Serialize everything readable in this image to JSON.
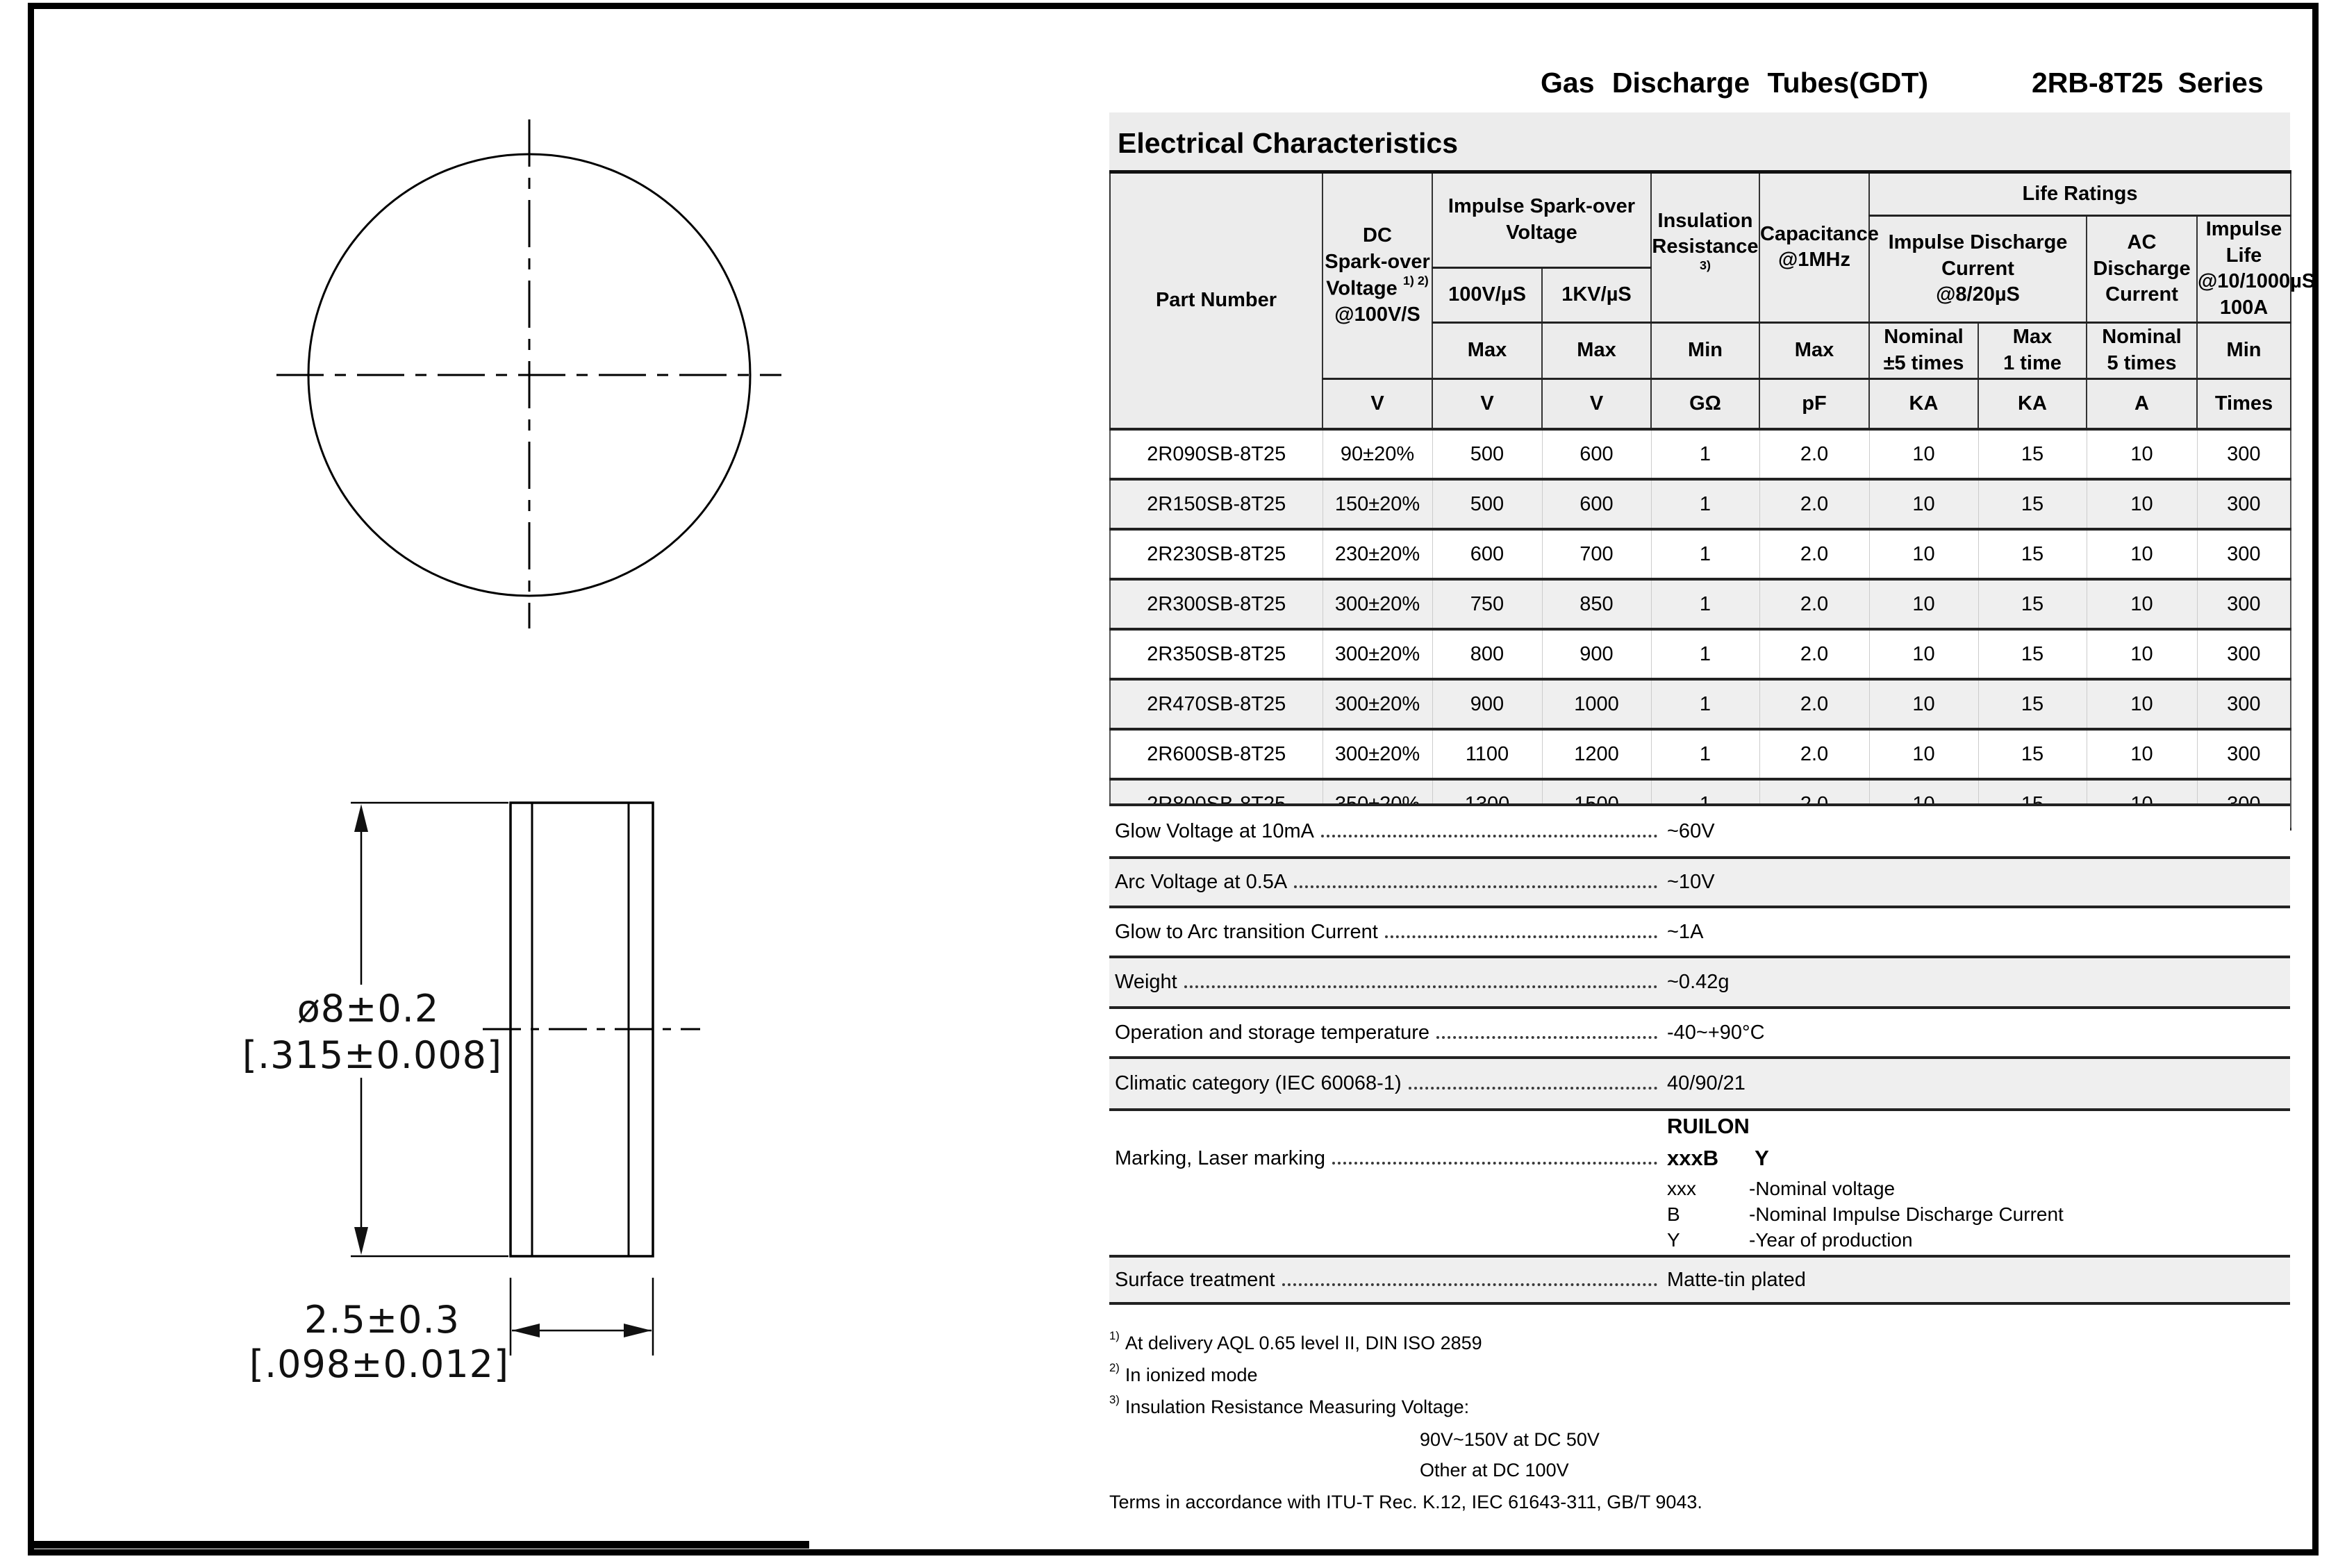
{
  "header": {
    "product": "Gas Discharge Tubes(GDT)",
    "series": "2RB-8T25 Series"
  },
  "section": {
    "title": "Electrical Characteristics"
  },
  "drawing": {
    "diameter_mm": "ø8±0.2",
    "diameter_inch": "[.315±0.008]",
    "thickness_mm": "2.5±0.3",
    "thickness_inch": "[.098±0.012]"
  },
  "table": {
    "head": {
      "part_number": "Part Number",
      "dc_l1": "DC",
      "dc_l2": "Spark-over",
      "dc_l3": "Voltage",
      "dc_sup": "1) 2)",
      "dc_l4": "@100V/S",
      "impulse_sparkover": "Impulse Spark-over Voltage",
      "col_100v": "100V/µS",
      "col_1kv": "1KV/µS",
      "ins_l1": "Insulation",
      "ins_l2": "Resistance",
      "ins_sup": "3)",
      "cap_l1": "Capacitance",
      "cap_l2": "@1MHz",
      "life_ratings": "Life Ratings",
      "idc_l1": "Impulse Discharge",
      "idc_l2": "Current",
      "idc_l3": "@8/20µS",
      "ac_l1": "AC",
      "ac_l2": "Discharge",
      "ac_l3": "Current",
      "life_l1": "Impulse Life",
      "life_l2": "@10/1000µS",
      "life_l3": "100A",
      "limits": [
        "Max",
        "Max",
        "Min",
        "Max",
        "Nominal\n±5 times",
        "Max\n1 time",
        "Nominal\n5 times",
        "Min"
      ],
      "units": [
        "V",
        "V",
        "V",
        "GΩ",
        "pF",
        "KA",
        "KA",
        "A",
        "Times"
      ]
    },
    "rows": [
      [
        "2R090SB-8T25",
        "90±20%",
        "500",
        "600",
        "1",
        "2.0",
        "10",
        "15",
        "10",
        "300"
      ],
      [
        "2R150SB-8T25",
        "150±20%",
        "500",
        "600",
        "1",
        "2.0",
        "10",
        "15",
        "10",
        "300"
      ],
      [
        "2R230SB-8T25",
        "230±20%",
        "600",
        "700",
        "1",
        "2.0",
        "10",
        "15",
        "10",
        "300"
      ],
      [
        "2R300SB-8T25",
        "300±20%",
        "750",
        "850",
        "1",
        "2.0",
        "10",
        "15",
        "10",
        "300"
      ],
      [
        "2R350SB-8T25",
        "300±20%",
        "800",
        "900",
        "1",
        "2.0",
        "10",
        "15",
        "10",
        "300"
      ],
      [
        "2R470SB-8T25",
        "300±20%",
        "900",
        "1000",
        "1",
        "2.0",
        "10",
        "15",
        "10",
        "300"
      ],
      [
        "2R600SB-8T25",
        "300±20%",
        "1100",
        "1200",
        "1",
        "2.0",
        "10",
        "15",
        "10",
        "300"
      ],
      [
        "2R800SB-8T25",
        "350±20%",
        "1300",
        "1500",
        "1",
        "2.0",
        "10",
        "15",
        "10",
        "300"
      ]
    ]
  },
  "properties": {
    "rows": [
      {
        "label": "Glow Voltage at 10mA",
        "value": "~60V"
      },
      {
        "label": "Arc Voltage at 0.5A",
        "value": "~10V"
      },
      {
        "label": "Glow to Arc transition Current",
        "value": "~1A"
      },
      {
        "label": "Weight",
        "value": "~0.42g"
      },
      {
        "label": "Operation and storage temperature",
        "value": "-40~+90°C"
      },
      {
        "label": "Climatic category (IEC 60068-1)",
        "value": "40/90/21"
      }
    ],
    "marking": {
      "label": "Marking, Laser marking",
      "brand": "RUILON",
      "code": "xxxB Y",
      "defs": [
        {
          "term": "xxx",
          "desc": "-Nominal voltage"
        },
        {
          "term": "B",
          "desc": "-Nominal Impulse Discharge Current"
        },
        {
          "term": "Y",
          "desc": "-Year of production"
        }
      ]
    },
    "surface": {
      "label": "Surface treatment",
      "value": "Matte-tin plated"
    }
  },
  "footnotes": {
    "fn1": {
      "sup": "1)",
      "text": "At delivery AQL 0.65 level II, DIN ISO 2859"
    },
    "fn2": {
      "sup": "2)",
      "text": "In ionized mode"
    },
    "fn3": {
      "sup": "3)",
      "text": "Insulation Resistance Measuring Voltage:"
    },
    "fn3_sub1": "90V~150V at DC 50V",
    "fn3_sub2": "Other at DC 100V",
    "terms": "Terms in accordance with ITU-T Rec. K.12, IEC 61643-311, GB/T 9043."
  }
}
